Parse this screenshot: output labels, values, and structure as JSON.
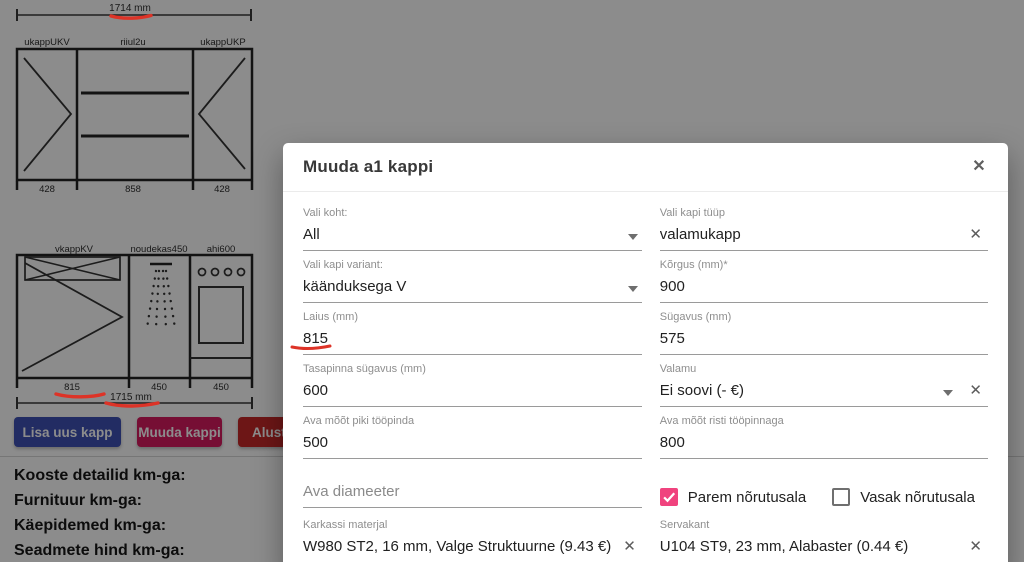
{
  "colors": {
    "button_blue": "#3f51b5",
    "button_pink": "#d81b60",
    "button_red": "#c62828",
    "accent_pink": "#f0437e",
    "annotation_red": "#dd3327",
    "backdrop": "rgba(0,0,0,0.45)"
  },
  "background": {
    "diagram1": {
      "total_dim": "1714 mm",
      "labels": [
        "ukappUKV",
        "riiul2u",
        "ukappUKP"
      ],
      "dims": [
        "428",
        "858",
        "428"
      ]
    },
    "diagram2": {
      "total_dim": "1715 mm",
      "labels": [
        "vkappKV",
        "noudekas450",
        "ahi600"
      ],
      "dims": [
        "815",
        "450",
        "450"
      ]
    },
    "buttons": {
      "add": "Lisa uus kapp",
      "edit": "Muuda kappi",
      "start": "Alust"
    },
    "totals": {
      "line1": "Kooste detailid km-ga:",
      "line2": "Furnituur km-ga:",
      "line3": "Käepidemed km-ga:",
      "line4": "Seadmete hind km-ga:"
    }
  },
  "modal": {
    "title": "Muuda a1 kappi",
    "close_icon": "✕",
    "fields": {
      "vali_koht": {
        "label": "Vali koht:",
        "value": "All"
      },
      "kapi_tyyp": {
        "label": "Vali kapi tüüp",
        "value": "valamukapp"
      },
      "kapi_variant": {
        "label": "Vali kapi variant:",
        "value": "käänduksega V"
      },
      "korgus": {
        "label": "Kõrgus (mm)*",
        "value": "900"
      },
      "laius": {
        "label": "Laius (mm)",
        "value": "815"
      },
      "sygavus": {
        "label": "Sügavus (mm)",
        "value": "575"
      },
      "tasapinna": {
        "label": "Tasapinna sügavus (mm)",
        "value": "600"
      },
      "valamu": {
        "label": "Valamu",
        "value": "Ei soovi (- €)"
      },
      "ava_piki": {
        "label": "Ava mõõt piki tööpinda",
        "value": "500"
      },
      "ava_risti": {
        "label": "Ava mõõt risti tööpinnaga",
        "value": "800"
      },
      "ava_diameeter": {
        "placeholder": "Ava diameeter"
      },
      "parem": {
        "label": "Parem nõrutusala",
        "checked": true
      },
      "vasak": {
        "label": "Vasak nõrutusala",
        "checked": false
      },
      "karkass": {
        "label": "Karkassi materjal",
        "value": "W980 ST2, 16 mm, Valge  Struktuurne (9.43 €)"
      },
      "servakant": {
        "label": "Servakant",
        "value": "U104 ST9, 23 mm, Alabaster (0.44 €)"
      }
    }
  }
}
